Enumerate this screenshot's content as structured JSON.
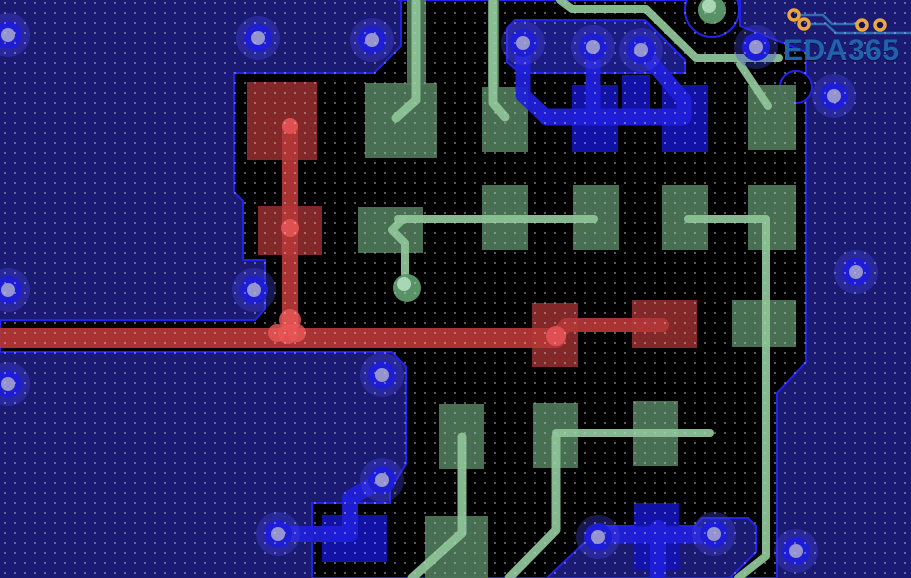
{
  "app": {
    "type_label": "pcb-layout-view",
    "watermark_text": "EDA365"
  },
  "logo": {
    "text": "EDA365",
    "text_color": "#1e63ab",
    "trace_color": "#2e6cb2",
    "pad_color": "#eda63d",
    "pads": [
      [
        794,
        15
      ],
      [
        804,
        24
      ],
      [
        862,
        25
      ],
      [
        880,
        25
      ]
    ],
    "paths": [
      "M800,15 H823 L832,24 H856",
      "M810,24 H826 L836,33 H911",
      "M880,31 V26"
    ]
  },
  "pcb": {
    "canvas": {
      "width": 911,
      "height": 578
    },
    "colors": {
      "pour": "#1a1a73",
      "black": "#000000",
      "boundary": "#2222ee",
      "island": "#1b1b84",
      "pad_red": "#8c2b2b",
      "trace_red": "#b23636",
      "bright_red": "#e85555",
      "pad_green": "#4d7758",
      "trace_green": "#8cc296",
      "via_green_ring": "#5d9a6b",
      "via_green_core": "#b2dfbb",
      "pad_blue": "#1212b2",
      "trace_blue": "#1f1fd9",
      "via_ring": "#1d1dd6",
      "via_core": "#9494ce",
      "via_halo": "rgba(70,70,230,0.35)",
      "dot": "#c9c9de"
    },
    "black_region": "398,0 740,0 740,26 806,52 806,362 777,393 777,578 312,578 312,503 390,503 390,490 406,464 406,367 392,352 0,352 0,320 255,320 265,309 265,260 243,260 243,201 234,192 234,73 374,73 401,46 401,0",
    "island": "507,62 507,28 515,20 645,20 685,60 685,73 520,73",
    "pour_shapes": [
      "547,578 602,526 695,526 702,518 748,518 756,526 756,552 730,578"
    ],
    "black_circles": [
      {
        "cx": 712,
        "cy": 10,
        "r": 27
      },
      {
        "cx": 796,
        "cy": 87,
        "r": 16
      }
    ],
    "pads_red": [
      [
        247,
        82,
        70,
        78
      ],
      [
        258,
        206,
        64,
        49
      ],
      [
        532,
        303,
        46,
        64
      ],
      [
        632,
        300,
        65,
        48
      ]
    ],
    "pads_green": [
      [
        407,
        0,
        19,
        85
      ],
      [
        488,
        0,
        11,
        88
      ],
      [
        365,
        83,
        72,
        75
      ],
      [
        482,
        87,
        46,
        65
      ],
      [
        748,
        85,
        48,
        65
      ],
      [
        358,
        207,
        65,
        46
      ],
      [
        482,
        185,
        46,
        65
      ],
      [
        573,
        185,
        46,
        65
      ],
      [
        662,
        185,
        46,
        65
      ],
      [
        748,
        185,
        48,
        65
      ],
      [
        732,
        300,
        64,
        47
      ],
      [
        439,
        404,
        45,
        65
      ],
      [
        533,
        403,
        45,
        65
      ],
      [
        633,
        401,
        45,
        65
      ],
      [
        425,
        516,
        63,
        62
      ]
    ],
    "pads_blue": [
      [
        572,
        85,
        46,
        67
      ],
      [
        622,
        75,
        28,
        50
      ],
      [
        662,
        85,
        46,
        67
      ],
      [
        322,
        515,
        65,
        47
      ],
      [
        634,
        503,
        45,
        67
      ]
    ],
    "traces_red": [
      {
        "pts": "0,338 556,338",
        "w": 20
      },
      {
        "pts": "290,126 290,332",
        "w": 16
      },
      {
        "pts": "556,337 566,325 662,325",
        "w": 14
      }
    ],
    "traces_green": [
      {
        "pts": "416,2 416,100 396,118",
        "w": 9
      },
      {
        "pts": "493,2 493,103 505,117",
        "w": 9
      },
      {
        "pts": "560,0 572,9 646,9 696,58 779,58",
        "w": 8
      },
      {
        "pts": "740,64 768,106",
        "w": 8
      },
      {
        "pts": "398,219 594,219",
        "w": 8
      },
      {
        "pts": "403,219 392,230 405,243 405,274",
        "w": 8
      },
      {
        "pts": "688,219 766,219 766,556 738,578",
        "w": 8
      },
      {
        "pts": "462,437 462,533 412,578",
        "w": 9
      },
      {
        "pts": "556,433 710,433",
        "w": 8
      },
      {
        "pts": "556,437 556,530 509,578",
        "w": 9
      }
    ],
    "traces_blue": [
      {
        "pts": "523,45 523,95 545,116",
        "w": 15
      },
      {
        "pts": "593,47 593,117",
        "w": 15
      },
      {
        "pts": "641,50 684,100 684,116",
        "w": 15
      },
      {
        "pts": "547,117 683,117",
        "w": 17
      },
      {
        "pts": "278,534 350,534 350,498 380,481",
        "w": 16
      },
      {
        "pts": "598,535 714,535",
        "w": 17
      },
      {
        "pts": "658,528 658,578",
        "w": 16
      }
    ],
    "red_blobs": [
      {
        "cx": 290,
        "cy": 228,
        "r": 9
      },
      {
        "cx": 290,
        "cy": 320,
        "r": 11
      },
      {
        "cx": 277,
        "cy": 333,
        "r": 9
      },
      {
        "cx": 297,
        "cy": 333,
        "r": 9
      },
      {
        "cx": 288,
        "cy": 334,
        "r": 10
      },
      {
        "cx": 556,
        "cy": 336,
        "r": 10
      },
      {
        "cx": 290,
        "cy": 126,
        "r": 8
      }
    ],
    "vias_blue": [
      [
        8,
        35
      ],
      [
        258,
        38
      ],
      [
        372,
        40
      ],
      [
        523,
        43
      ],
      [
        593,
        47
      ],
      [
        641,
        50
      ],
      [
        756,
        47
      ],
      [
        834,
        96
      ],
      [
        856,
        272
      ],
      [
        8,
        290
      ],
      [
        254,
        290
      ],
      [
        8,
        384
      ],
      [
        382,
        375
      ],
      [
        382,
        480
      ],
      [
        278,
        534
      ],
      [
        598,
        537
      ],
      [
        714,
        534
      ],
      [
        796,
        551
      ]
    ],
    "vias_green": [
      [
        712,
        10
      ],
      [
        407,
        288
      ]
    ],
    "grid": {
      "spacing": 10,
      "dot_r": 0.9,
      "opacity": 0.72,
      "offset_x": 4,
      "offset_y": 2
    }
  }
}
